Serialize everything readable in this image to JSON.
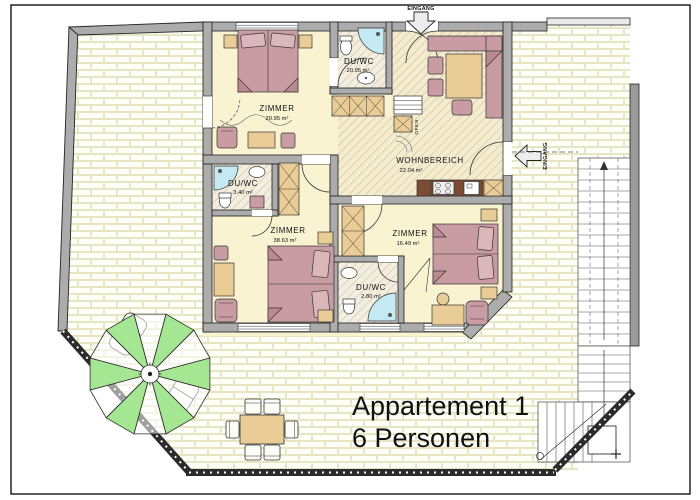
{
  "title": {
    "line1": "Appartement 1",
    "line2": "6 Personen"
  },
  "entrances": {
    "top": "EINGANG",
    "right": "EINGANG"
  },
  "oven_label": "OFEN",
  "rooms": {
    "zimmer_nw": {
      "name": "ZIMMER",
      "area": "20.95 m²"
    },
    "duwc_top": {
      "name": "DU/WC",
      "area": "20.95 m²"
    },
    "wohnbereich": {
      "name": "WOHNBEREICH",
      "area": "22.04 m²"
    },
    "duwc_west": {
      "name": "DU/WC",
      "area": "3.40 m²"
    },
    "zimmer_sw": {
      "name": "ZIMMER",
      "area": "38.63 m²"
    },
    "zimmer_se": {
      "name": "ZIMMER",
      "area": "16.49 m²"
    },
    "duwc_south": {
      "name": "DU/WC",
      "area": "2.80 m²"
    }
  },
  "colors": {
    "wall_gray": "#ACACAC",
    "floor_cream": "#FAF3D2",
    "brick_mortar": "#F6F6DE",
    "furniture_pink": "#C99CA3",
    "pillow_pink": "#DBB6BB",
    "furniture_tan": "#EACD96",
    "fixture_blue": "#C5E9F2",
    "counter_brown": "#7B4B33",
    "parasol_green": "#A5E693",
    "railing_dark": "#2B2B2B"
  }
}
